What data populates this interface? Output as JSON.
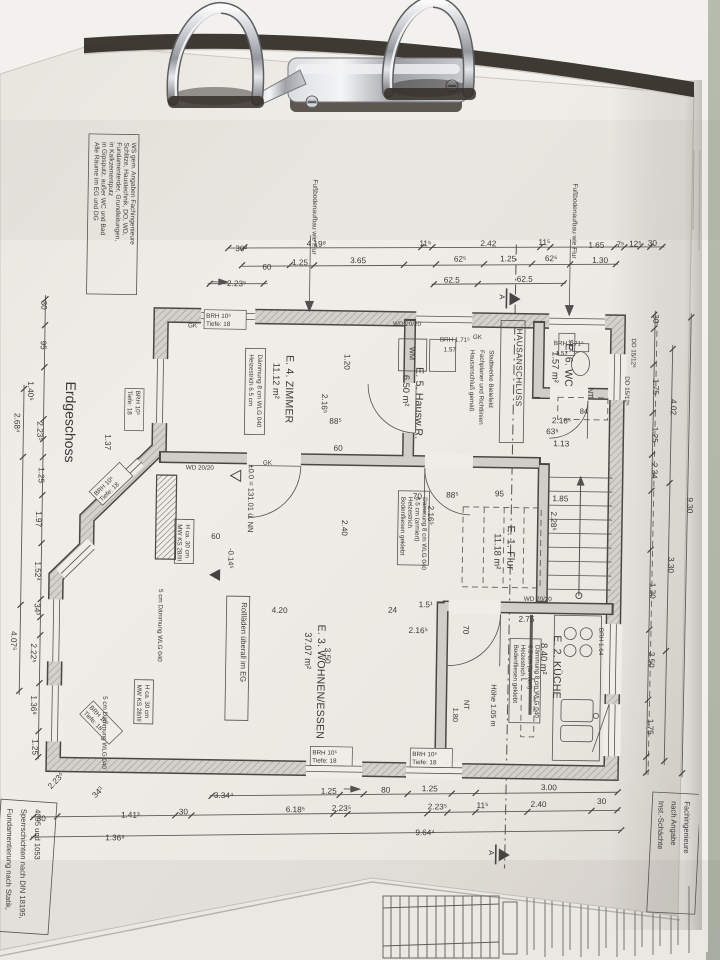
{
  "photo": {
    "table_color": "#b4baab",
    "paper_color": "#eeebe5",
    "ink_color": "#2f2e2c",
    "wall_fill": "#d0cdc8",
    "binder_shadow": "#221c17"
  },
  "plan": {
    "title": "Erdgeschoss",
    "rooms": [
      {
        "name": "E. 1. Flur",
        "area": "11.18 m²",
        "x": 508,
        "y": 523
      },
      {
        "name": "E. 2. KÜCHE",
        "area": "8.40 m²",
        "x": 556,
        "y": 632
      },
      {
        "name": "E. 3. WOHNEN/ESSEN",
        "area": "37.07 m²",
        "x": 320,
        "y": 625
      },
      {
        "name": "E. 4. ZIMMER",
        "area": "11.12 m²",
        "x": 284,
        "y": 356
      },
      {
        "name": "E. 5. Hausw.R.",
        "area": "6.50 m²",
        "x": 414,
        "y": 366
      },
      {
        "name": "E. 6. WC",
        "area": "1.57 m²",
        "x": 563,
        "y": 340
      }
    ],
    "levels": {
      "zero": "±0.0 = 131.01 ü. NN",
      "minus": "-0.14⁵"
    },
    "section_mark": "A",
    "window_tag": [
      "BRH 10⁵",
      "Tiefe: 18"
    ],
    "windows": [
      {
        "x": 203,
        "y": 320,
        "r": 0
      },
      {
        "x": 316,
        "y": 755,
        "r": 0
      },
      {
        "x": 416,
        "y": 755,
        "r": 0
      },
      {
        "x": 134,
        "y": 394,
        "r": 90
      },
      {
        "x": 96,
        "y": 500,
        "r": -45
      },
      {
        "x": 92,
        "y": 712,
        "r": 45
      }
    ],
    "notes": {
      "top_left": {
        "lines": [
          "Alle Räume im EG und DG",
          "in Gipsputz, außer WC und Bad",
          "in Kalkzementputz",
          "Fundamenterder, Grundleitungen,",
          "Schlitze, Haustechnik, DO, WD,",
          "WS gem. Angaben Fachingenieure"
        ],
        "x": 89,
        "y": 146,
        "dx": 7.4
      },
      "bottom_left": {
        "lines": [
          "Fundamentierung nach Statik,",
          "Sperrschichten nach DIN 18195,",
          "4095 und 1053"
        ],
        "x": 12,
        "y": 814,
        "dx": 14
      },
      "bottom_right": {
        "lines": [
          "Inst.-Schächte",
          "nach Angabe",
          "Fachingenieure"
        ],
        "x": 663,
        "y": 796,
        "dx": 13
      },
      "hausanschluss_tag": "HAUSANSCHLUSS",
      "hausanschluss": {
        "lines": [
          "Hausanschluß gemäß",
          "Fachplaner und Richtlinien",
          "Stadtwerke Bielefeld"
        ],
        "x": 468,
        "y": 348,
        "dx": 9.5
      },
      "rolladen": "Rollläden überall im EG",
      "fussboden": "Fußbodenaufbau wie Flur",
      "floor_flur": {
        "lines": [
          "Bodenfliesen geklebt",
          "Heizestrich",
          "6.5 cm (armiert)",
          "Dämmung 8 cm WLG 040"
        ],
        "x": 401,
        "y": 496,
        "dx": 7.2
      },
      "floor_kueche": {
        "lines": [
          "Bodenfliesen geklebt",
          "Heizestrich",
          "6.5 cm (armiert)",
          "Dämmung 8 cm WLG 040"
        ],
        "x": 516,
        "y": 642,
        "dx": 7.2
      },
      "floor_e4": {
        "lines": [
          "Heizestrich 6.5 cm",
          "Dämmung 8 cm WLG 040"
        ],
        "x": 247,
        "y": 356,
        "dx": 8.5
      },
      "mw1": {
        "lines": [
          "MW KS 28/III",
          "H ca. 30 cm"
        ],
        "x": 178,
        "y": 527,
        "dx": 8
      },
      "mw2": {
        "lines": [
          "MW KS 28/III",
          "H ca. 30 cm"
        ],
        "x": 140,
        "y": 688,
        "dx": 8
      }
    },
    "labels": [
      {
        "t": "WM",
        "x": 407,
        "y": 346,
        "r": 90,
        "c": "lbl"
      },
      {
        "t": "SKA",
        "x": 566,
        "y": 336,
        "r": 90,
        "c": "tiny"
      },
      {
        "t": "NT",
        "x": 586,
        "y": 384,
        "r": 90,
        "c": "lbl"
      },
      {
        "t": "84",
        "x": 578,
        "y": 410,
        "r": 0,
        "c": "lbl"
      },
      {
        "t": "NT",
        "x": 467,
        "y": 698,
        "r": 90,
        "c": "lbl"
      },
      {
        "t": "1.80",
        "x": 456,
        "y": 706,
        "r": 90,
        "c": "lbl"
      },
      {
        "t": "Höhe 1.05 m",
        "x": 494,
        "y": 682,
        "r": 90,
        "c": "lbl"
      },
      {
        "t": "WD 20/20",
        "x": 390,
        "y": 325,
        "r": 0,
        "c": "tiny"
      },
      {
        "t": "WD 20/20",
        "x": 185,
        "y": 472,
        "r": 0,
        "c": "tiny"
      },
      {
        "t": "WD 20/20",
        "x": 525,
        "y": 598,
        "r": 0,
        "c": "tiny"
      },
      {
        "t": "BRH 1.71⁵",
        "x": 437,
        "y": 340,
        "r": 0,
        "c": "tiny"
      },
      {
        "t": "1.57",
        "x": 441,
        "y": 350,
        "r": 0,
        "c": "tiny"
      },
      {
        "t": "BRH 1.71⁵",
        "x": 551,
        "y": 342,
        "r": 0,
        "c": "tiny"
      },
      {
        "t": "1.57",
        "x": 553,
        "y": 352,
        "r": 0,
        "c": "tiny"
      },
      {
        "t": "BRH 1.64",
        "x": 601,
        "y": 624,
        "r": 90,
        "c": "tiny"
      },
      {
        "t": "GK",
        "x": 470,
        "y": 337,
        "r": 0,
        "c": "tiny"
      },
      {
        "t": "GK",
        "x": 185,
        "y": 330,
        "r": 0,
        "c": "tiny"
      },
      {
        "t": "GK",
        "x": 262,
        "y": 466,
        "r": 0,
        "c": "tiny"
      },
      {
        "t": "5 cm Dämmung WLG 040",
        "x": 160,
        "y": 592,
        "r": 90,
        "c": "tiny"
      },
      {
        "t": "5 cm Dämmung WLG 040",
        "x": 106,
        "y": 700,
        "r": 90,
        "c": "tiny"
      },
      {
        "t": "DD 15/12⁸",
        "x": 629,
        "y": 334,
        "r": 90,
        "c": "tiny"
      },
      {
        "t": "DD 15/12⁸",
        "x": 623,
        "y": 372,
        "r": 90,
        "c": "tiny"
      }
    ],
    "dims": [
      {
        "t": "30²",
        "x": 237,
        "y": 253,
        "r": 0
      },
      {
        "t": "4.19⁸",
        "x": 312,
        "y": 247,
        "r": 0
      },
      {
        "t": "11⁵",
        "x": 421,
        "y": 245,
        "r": 0
      },
      {
        "t": "2.42",
        "x": 484,
        "y": 244,
        "r": 0
      },
      {
        "t": "11⁵",
        "x": 540,
        "y": 242,
        "r": 0
      },
      {
        "t": "1.65",
        "x": 592,
        "y": 244,
        "r": 0
      },
      {
        "t": "7⁵",
        "x": 616,
        "y": 243,
        "r": 0
      },
      {
        "t": "12⁵",
        "x": 631,
        "y": 242,
        "r": 0
      },
      {
        "t": "30",
        "x": 648,
        "y": 241,
        "r": 0
      },
      {
        "t": "60",
        "x": 263,
        "y": 271,
        "r": 0
      },
      {
        "t": "1.25",
        "x": 296,
        "y": 266,
        "r": 0
      },
      {
        "t": "3.65",
        "x": 354,
        "y": 263,
        "r": 0
      },
      {
        "t": "62⁵",
        "x": 456,
        "y": 260,
        "r": 0
      },
      {
        "t": "1.25",
        "x": 504,
        "y": 259,
        "r": 0
      },
      {
        "t": "62⁵",
        "x": 547,
        "y": 258,
        "r": 0
      },
      {
        "t": "1.30",
        "x": 596,
        "y": 259,
        "r": 0
      },
      {
        "t": "2.23⁵",
        "x": 233,
        "y": 288,
        "r": 0
      },
      {
        "t": "62.5",
        "x": 448,
        "y": 281,
        "r": 0
      },
      {
        "t": "62.5",
        "x": 521,
        "y": 279,
        "r": 0
      },
      {
        "t": "3.34⁴",
        "x": 228,
        "y": 800,
        "r": 0
      },
      {
        "t": "1.25",
        "x": 333,
        "y": 794,
        "r": 0
      },
      {
        "t": "80",
        "x": 390,
        "y": 792,
        "r": 0
      },
      {
        "t": "1.25",
        "x": 434,
        "y": 790,
        "r": 0
      },
      {
        "t": "3.00",
        "x": 553,
        "y": 787,
        "r": 0
      },
      {
        "t": "30",
        "x": 46,
        "y": 826,
        "r": 0
      },
      {
        "t": "1.41³",
        "x": 135,
        "y": 821,
        "r": 0
      },
      {
        "t": "30",
        "x": 188,
        "y": 817,
        "r": 0
      },
      {
        "t": "6.18⁵",
        "x": 300,
        "y": 813,
        "r": 0
      },
      {
        "t": "2.23⁵",
        "x": 346,
        "y": 811,
        "r": 0
      },
      {
        "t": "2.23⁵",
        "x": 442,
        "y": 808,
        "r": 0
      },
      {
        "t": "11⁵",
        "x": 487,
        "y": 806,
        "r": 0
      },
      {
        "t": "2.40",
        "x": 543,
        "y": 804,
        "r": 0
      },
      {
        "t": "30",
        "x": 606,
        "y": 800,
        "r": 0
      },
      {
        "t": "1.36⁹",
        "x": 120,
        "y": 844,
        "r": 0
      },
      {
        "t": "9.64⁴",
        "x": 430,
        "y": 834,
        "r": 0
      },
      {
        "t": "2.23⁵",
        "x": 62,
        "y": 787,
        "r": -47
      },
      {
        "t": "34³",
        "x": 104,
        "y": 798,
        "r": -47
      },
      {
        "t": "30",
        "x": 38,
        "y": 310,
        "r": 90
      },
      {
        "t": "95",
        "x": 38,
        "y": 350,
        "r": 90
      },
      {
        "t": "1.40⁵",
        "x": 26,
        "y": 396,
        "r": 90
      },
      {
        "t": "2.68⁴",
        "x": 13,
        "y": 428,
        "r": 90
      },
      {
        "t": "2.23⁵",
        "x": 36,
        "y": 436,
        "r": 90
      },
      {
        "t": "1.25",
        "x": 38,
        "y": 480,
        "r": 90
      },
      {
        "t": "1.97",
        "x": 36,
        "y": 524,
        "r": 90
      },
      {
        "t": "1.52⁴",
        "x": 36,
        "y": 576,
        "r": 90
      },
      {
        "t": "34³",
        "x": 36,
        "y": 614,
        "r": 90
      },
      {
        "t": "4.07⁵",
        "x": 13,
        "y": 646,
        "r": 90
      },
      {
        "t": "2.22⁵",
        "x": 33,
        "y": 658,
        "r": 90
      },
      {
        "t": "1.36⁸",
        "x": 34,
        "y": 710,
        "r": 90
      },
      {
        "t": "1.25",
        "x": 36,
        "y": 752,
        "r": 90
      },
      {
        "t": "1.37",
        "x": 104,
        "y": 446,
        "r": 90
      },
      {
        "t": "30",
        "x": 650,
        "y": 314,
        "r": 90
      },
      {
        "t": "1.75",
        "x": 651,
        "y": 382,
        "r": 90
      },
      {
        "t": "4.02",
        "x": 669,
        "y": 402,
        "r": 90
      },
      {
        "t": "1.25",
        "x": 651,
        "y": 430,
        "r": 90
      },
      {
        "t": "2.34",
        "x": 651,
        "y": 466,
        "r": 90
      },
      {
        "t": "9.30",
        "x": 687,
        "y": 500,
        "r": 90
      },
      {
        "t": "3.30",
        "x": 669,
        "y": 560,
        "r": 90
      },
      {
        "t": "1.30",
        "x": 651,
        "y": 586,
        "r": 90
      },
      {
        "t": "3.50",
        "x": 651,
        "y": 655,
        "r": 90
      },
      {
        "t": "1.75",
        "x": 651,
        "y": 722,
        "r": 90
      },
      {
        "t": "1.20",
        "x": 342,
        "y": 362,
        "r": 90
      },
      {
        "t": "2.16⁵",
        "x": 320,
        "y": 404,
        "r": 90
      },
      {
        "t": "88⁵",
        "x": 334,
        "y": 424,
        "r": 0
      },
      {
        "t": "60",
        "x": 337,
        "y": 451,
        "r": 0
      },
      {
        "t": "70",
        "x": 417,
        "y": 498,
        "r": 0
      },
      {
        "t": "88⁵",
        "x": 452,
        "y": 496,
        "r": 0
      },
      {
        "t": "95",
        "x": 499,
        "y": 494,
        "r": 0
      },
      {
        "t": "1.85",
        "x": 560,
        "y": 498,
        "r": 0
      },
      {
        "t": "2.16⁵",
        "x": 428,
        "y": 514,
        "r": 90
      },
      {
        "t": "2.28⁵",
        "x": 551,
        "y": 518,
        "r": 90
      },
      {
        "t": "2.40",
        "x": 342,
        "y": 528,
        "r": 90
      },
      {
        "t": "4.20",
        "x": 281,
        "y": 614,
        "r": 0
      },
      {
        "t": "24",
        "x": 394,
        "y": 612,
        "r": 0
      },
      {
        "t": "1.5¹",
        "x": 427,
        "y": 606,
        "r": 0
      },
      {
        "t": "2.16⁵",
        "x": 420,
        "y": 632,
        "r": 0
      },
      {
        "t": "70",
        "x": 465,
        "y": 628,
        "r": 90
      },
      {
        "t": "2.75",
        "x": 528,
        "y": 619,
        "r": 0
      },
      {
        "t": "3.50",
        "x": 327,
        "y": 656,
        "r": 90
      },
      {
        "t": "63⁵",
        "x": 551,
        "y": 431,
        "r": 0
      },
      {
        "t": "1.13",
        "x": 560,
        "y": 443,
        "r": 0
      },
      {
        "t": "2.16⁵",
        "x": 560,
        "y": 420,
        "r": 0
      },
      {
        "t": "60",
        "x": 216,
        "y": 541,
        "r": 0
      }
    ]
  }
}
